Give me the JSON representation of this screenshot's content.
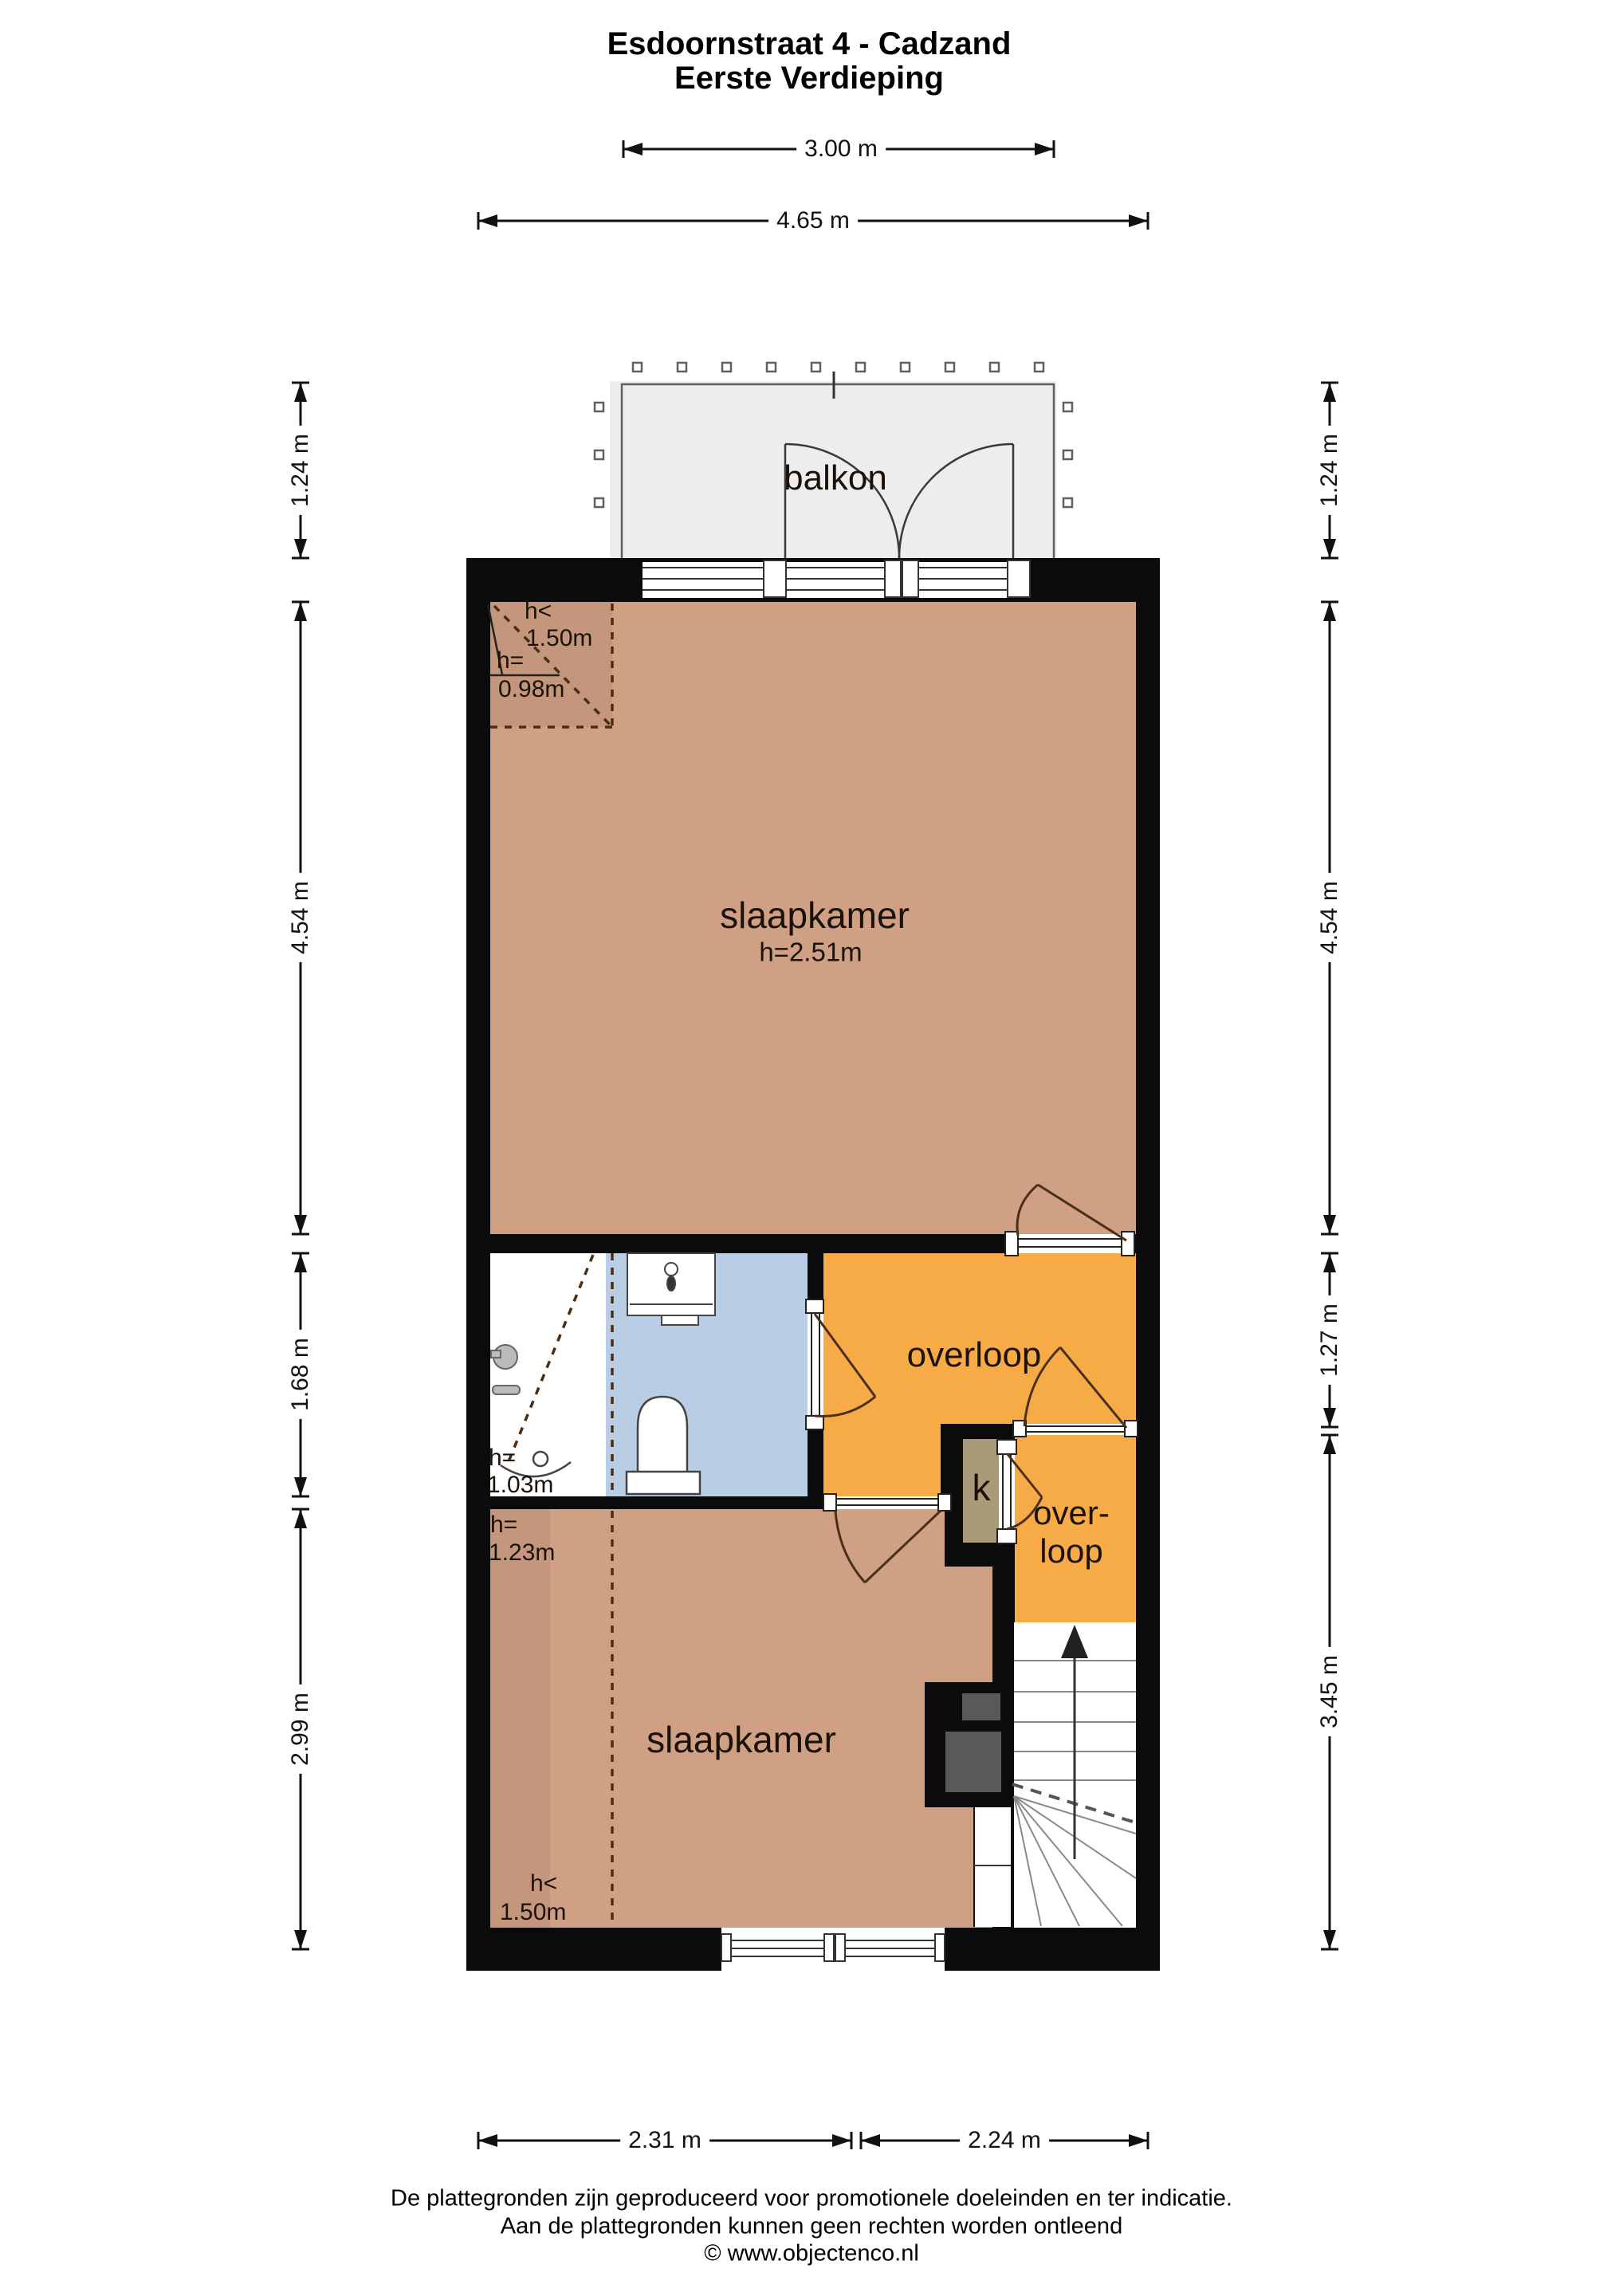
{
  "title": {
    "line1": "Esdoornstraat 4 - Cadzand",
    "line2": "Eerste Verdieping"
  },
  "rooms": {
    "balcony": "balkon",
    "bedroom1": "slaapkamer",
    "bedroom1_height": "h=2.51m",
    "bathroom_note_h": "h=",
    "bathroom_note_v": "1.03m",
    "landing": "overloop",
    "landing2_line1": "over-",
    "landing2_line2": "loop",
    "closet": "k",
    "bedroom2": "slaapkamer"
  },
  "annotations": {
    "bed1_corner_h_lt": "h<",
    "bed1_corner_150": "1.50m",
    "bed1_corner_h_eq": "h=",
    "bed1_corner_098": "0.98m",
    "bed2_h_eq": "h=",
    "bed2_123": "1.23m",
    "bed2_h_lt": "h<",
    "bed2_150": "1.50m"
  },
  "dimensions": {
    "top_balcony_width": "3.00 m",
    "top_total_width": "4.65 m",
    "left_balcony_depth": "1.24 m",
    "left_bedroom1_depth": "4.54 m",
    "left_bathroom_depth": "1.68 m",
    "left_bedroom2_depth": "2.99 m",
    "right_balcony_depth": "1.24 m",
    "right_bedroom1_depth": "4.54 m",
    "right_landing_depth": "1.27 m",
    "right_stairs_depth": "3.45 m",
    "bottom_left_width": "2.31 m",
    "bottom_right_width": "2.24 m"
  },
  "footer": {
    "line1": "De plattegronden zijn geproduceerd voor promotionele doeleinden en ter indicatie.",
    "line2": "Aan de plattegronden kunnen geen rechten worden ontleend",
    "line3": "© www.objectenco.nl"
  },
  "colors": {
    "wall": "#0b0b0b",
    "bedroom_fill": "#cfa083",
    "bedroom_low_ceiling_fill": "#c4967b",
    "landing_fill": "#f6ab46",
    "bathroom_fill": "#b9cde5",
    "closet_fill": "#a99a7a",
    "balcony_fill": "#ededed",
    "door_arc": "#4a3019"
  },
  "icons": {
    "toilet": "toilet-icon",
    "washbasin": "washbasin-icon",
    "round_basin": "round-basin-icon",
    "shower": "shower-fixture-icon",
    "stairs_arrow": "stairs-up-arrow-icon"
  }
}
